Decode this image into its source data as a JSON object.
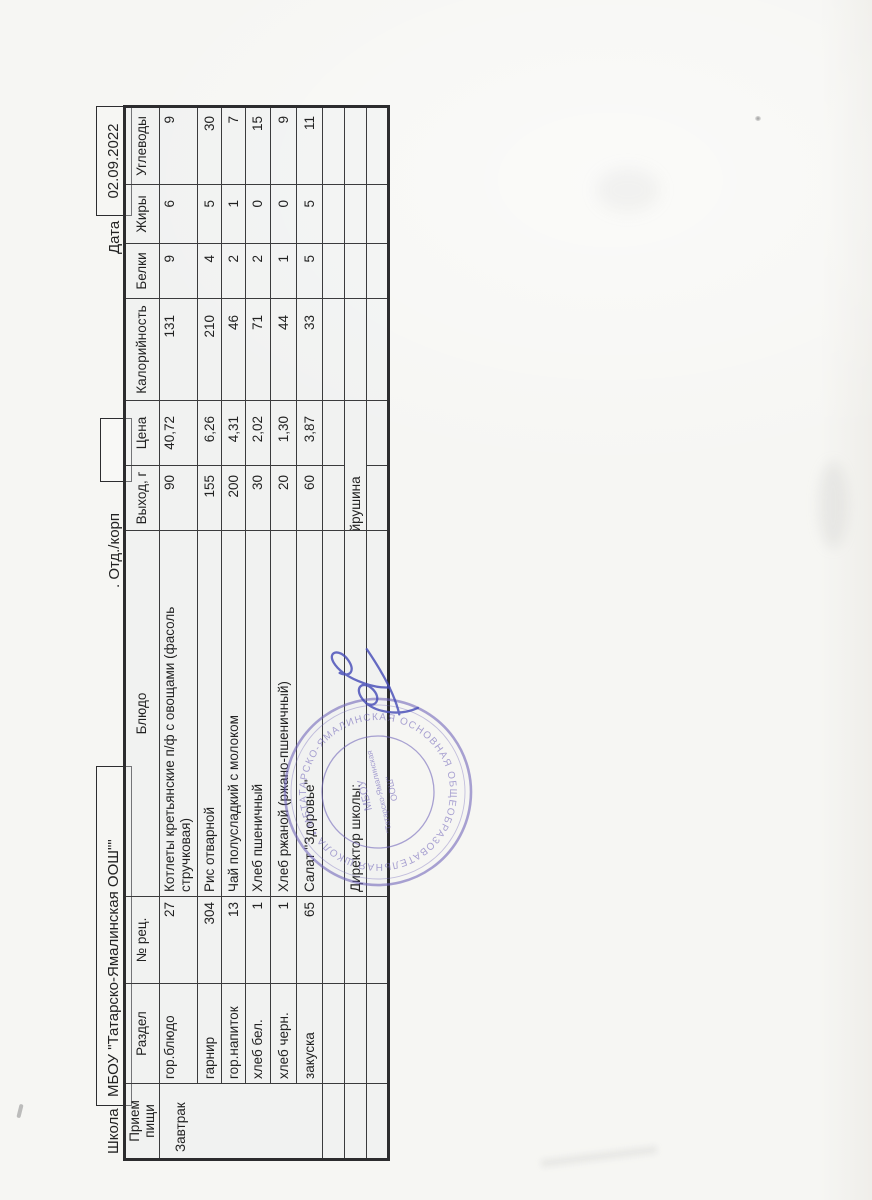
{
  "page": {
    "school_label": "Школа",
    "school_name": "МБОУ \"Татарско-Ямалинская ООШ\"\"",
    "dept_label": ". Отд./корп",
    "date_label": "Дата",
    "date_value": "02.09.2022"
  },
  "table": {
    "headers": [
      "Прием пищи",
      "Раздел",
      "№ рец.",
      "Блюдо",
      "Выход, г",
      "Цена",
      "Калорийность",
      "Белки",
      "Жиры",
      "Углеводы"
    ],
    "meal_group": "Завтрак",
    "rows": [
      {
        "section": "гор.блюдо",
        "rec": "27",
        "dish": "Котлеты кретьянские п/ф с овощами (фасоль\nстручковая)",
        "output": "90",
        "price": "40,72",
        "kcal": "131",
        "protein": "9",
        "fat": "6",
        "carbs": "9"
      },
      {
        "section": "гарнир",
        "rec": "304",
        "dish": "Рис отварной",
        "output": "155",
        "price": "6,26",
        "kcal": "210",
        "protein": "4",
        "fat": "5",
        "carbs": "30"
      },
      {
        "section": "гор.напиток",
        "rec": "13",
        "dish": "Чай полусладкий с молоком",
        "output": "200",
        "price": "4,31",
        "kcal": "46",
        "protein": "2",
        "fat": "1",
        "carbs": "7"
      },
      {
        "section": "хлеб бел.",
        "rec": "1",
        "dish": "Хлеб пшеничный",
        "output": "30",
        "price": "2,02",
        "kcal": "71",
        "protein": "2",
        "fat": "0",
        "carbs": "15"
      },
      {
        "section": "хлеб черн.",
        "rec": "1",
        "dish": "Хлеб ржаной (ржано-пшеничный)",
        "output": "20",
        "price": "1,30",
        "kcal": "44",
        "protein": "1",
        "fat": "0",
        "carbs": "9"
      },
      {
        "section": "закуска",
        "rec": "65",
        "dish": "Салат \"Здоровье\"",
        "output": "60",
        "price": "3,87",
        "kcal": "33",
        "protein": "5",
        "fat": "5",
        "carbs": "11"
      }
    ],
    "director_label": "Директор школы:",
    "director_name": "Г.Г.Файрушина"
  },
  "stamp": {
    "ring_text": "ТАТАРСКО-ЯМАЛИНСКАЯ ОСНОВНАЯ ОБЩЕОБРАЗОВАТЕЛЬНАЯ ШКОЛА • МБОУ • ",
    "center_line1": "МБОУ",
    "center_line2": "\"Татарско-Ямалинская",
    "center_line3": "ООШ\""
  },
  "colors": {
    "paper": "#f5f5f2",
    "table_line": "#3b3b3d",
    "ink": "#242424",
    "stamp": "#6f63b8",
    "signature": "#464cb8"
  }
}
